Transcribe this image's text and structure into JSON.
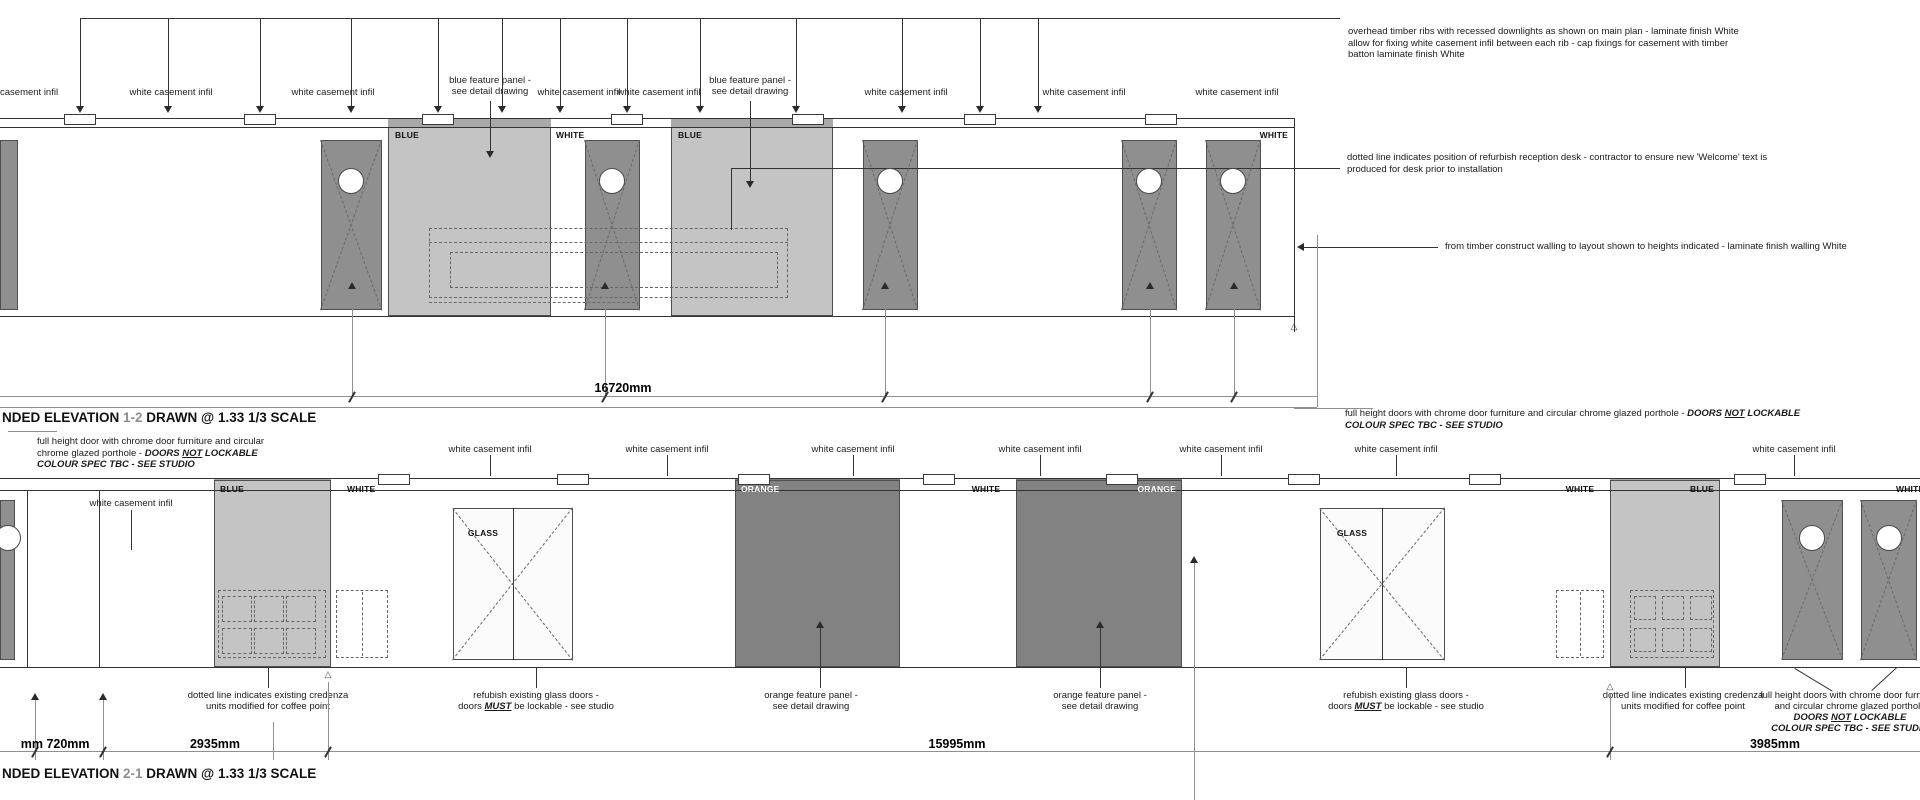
{
  "ann": {
    "a1": {
      "l1": "overhead timber ribs with recessed downlights as shown on main plan - laminate finish White",
      "l2": "allow for fixing white casement infil between each rib - cap fixings for casement with timber",
      "l3": "batton laminate finish White"
    },
    "a2": {
      "l1": "dotted line indicates position of refurbish reception desk - contractor to ensure new 'Welcome' text is",
      "l2": "produced for desk prior to installation"
    },
    "a3": {
      "l1": "from timber construct walling to layout shown to heights indicated - laminate finish walling White"
    },
    "a4": {
      "pre": "full height doors with chrome door furniture and circular chrome glazed porthole - ",
      "b1": "DOORS ",
      "u": "NOT",
      "b2": " LOCKABLE",
      "l2": "COLOUR SPEC TBC - SEE STUDIO"
    },
    "a5": {
      "l1": "full height door with chrome door furniture and circular",
      "pre": "chrome glazed porthole - ",
      "b1": "DOORS ",
      "u": "NOT",
      "b2": " LOCKABLE",
      "l3": "COLOUR SPEC TBC - SEE STUDIO"
    },
    "credenza": {
      "l1": "dotted line indicates existing credenza",
      "l2": "units modified for coffee point"
    },
    "glassdoors": {
      "l1": "refubish existing glass doors -",
      "pre": "doors ",
      "u": "MUST",
      "post": " be lockable - see studio"
    },
    "orangepanel": {
      "l1": "orange feature panel -",
      "l2": "see detail drawing"
    },
    "bottomdoors": {
      "l1": "full height doors with chrome door furniture",
      "l2": "and circular chrome glazed porthole",
      "b1": "DOORS ",
      "u": "NOT",
      "b2": " LOCKABLE",
      "l4": "COLOUR SPEC TBC - SEE STUDIO"
    }
  },
  "titles": {
    "t1_pre": "NDED ELEVATION ",
    "t1_num": "1-2",
    "t1_post": " DRAWN @ 1.33 1/3 SCALE",
    "t2_pre": "NDED ELEVATION ",
    "t2_num": "2-1",
    "t2_post": " DRAWN @ 1.33 1/3 SCALE"
  },
  "colors": {
    "door_fill": "#8f8f8f",
    "blue_panel_fill": "#c4c4c4",
    "orange_panel_fill": "#828282",
    "glass_fill": "#fbfbfb",
    "line_dark": "#333333",
    "line_gray": "#8f8f8f",
    "dash": "#666666",
    "title_number_gray": "#8f8f8f"
  },
  "geom": {
    "rects": [
      [
        388,
        119,
        163,
        8,
        "railblue"
      ],
      [
        671,
        119,
        162,
        8,
        "railblue"
      ],
      [
        388,
        127,
        163,
        189,
        "blue"
      ],
      [
        671,
        127,
        162,
        189,
        "blue"
      ],
      [
        0,
        140,
        18,
        170,
        "door"
      ],
      [
        321,
        140,
        61,
        170,
        "door"
      ],
      [
        585,
        140,
        55,
        170,
        "door"
      ],
      [
        863,
        140,
        55,
        170,
        "door"
      ],
      [
        1122,
        140,
        55,
        170,
        "door"
      ],
      [
        1206,
        140,
        55,
        170,
        "door"
      ],
      [
        214,
        479,
        117,
        11,
        "railblue"
      ],
      [
        1610,
        479,
        110,
        11,
        "railblue"
      ],
      [
        735,
        479,
        165,
        11,
        "railorange"
      ],
      [
        1016,
        479,
        166,
        11,
        "railorange"
      ],
      [
        214,
        480,
        117,
        187,
        "blue"
      ],
      [
        1610,
        480,
        110,
        187,
        "blue"
      ],
      [
        735,
        480,
        165,
        187,
        "orange"
      ],
      [
        1016,
        480,
        166,
        187,
        "orange"
      ],
      [
        453,
        508,
        120,
        152,
        "glass"
      ],
      [
        1320,
        508,
        125,
        152,
        "glass"
      ],
      [
        0,
        500,
        15,
        160,
        "door"
      ],
      [
        1782,
        500,
        61,
        160,
        "door"
      ],
      [
        1861,
        500,
        56,
        160,
        "door"
      ],
      [
        429,
        228,
        359,
        70,
        "dashr"
      ],
      [
        450,
        252,
        328,
        36,
        "dashr"
      ],
      [
        218,
        590,
        108,
        68,
        "dashr"
      ],
      [
        222,
        596,
        30,
        26,
        "dashr"
      ],
      [
        254,
        596,
        30,
        26,
        "dashr"
      ],
      [
        286,
        596,
        30,
        26,
        "dashr"
      ],
      [
        222,
        628,
        30,
        26,
        "dashr"
      ],
      [
        254,
        628,
        30,
        26,
        "dashr"
      ],
      [
        286,
        628,
        30,
        26,
        "dashr"
      ],
      [
        336,
        590,
        52,
        68,
        "dashr"
      ],
      [
        1556,
        590,
        48,
        68,
        "dashr"
      ],
      [
        1630,
        590,
        84,
        68,
        "dashr"
      ],
      [
        1634,
        596,
        22,
        24,
        "dashr"
      ],
      [
        1662,
        596,
        22,
        24,
        "dashr"
      ],
      [
        1690,
        596,
        22,
        24,
        "dashr"
      ],
      [
        1634,
        628,
        22,
        24,
        "dashr"
      ],
      [
        1662,
        628,
        22,
        24,
        "dashr"
      ],
      [
        1690,
        628,
        22,
        24,
        "dashr"
      ]
    ],
    "plates": [
      [
        64,
        114,
        32,
        11
      ],
      [
        244,
        114,
        32,
        11
      ],
      [
        422,
        114,
        32,
        11
      ],
      [
        611,
        114,
        32,
        11
      ],
      [
        792,
        114,
        32,
        11
      ],
      [
        964,
        114,
        32,
        11
      ],
      [
        1145,
        114,
        32,
        11
      ],
      [
        378,
        474,
        32,
        11
      ],
      [
        557,
        474,
        32,
        11
      ],
      [
        738,
        474,
        32,
        11
      ],
      [
        923,
        474,
        32,
        11
      ],
      [
        1106,
        474,
        32,
        11
      ],
      [
        1288,
        474,
        32,
        11
      ],
      [
        1469,
        474,
        32,
        11
      ],
      [
        1734,
        474,
        32,
        11
      ]
    ],
    "lines": [
      [
        80,
        18,
        1340,
        18,
        0
      ],
      [
        80,
        18,
        80,
        106,
        0
      ],
      [
        168,
        18,
        168,
        106,
        0
      ],
      [
        260,
        18,
        260,
        106,
        0
      ],
      [
        351,
        18,
        351,
        106,
        0
      ],
      [
        438,
        18,
        438,
        106,
        0
      ],
      [
        502,
        18,
        502,
        106,
        0
      ],
      [
        560,
        18,
        560,
        106,
        0
      ],
      [
        627,
        18,
        627,
        106,
        0
      ],
      [
        700,
        18,
        700,
        106,
        0
      ],
      [
        796,
        18,
        796,
        106,
        0
      ],
      [
        902,
        18,
        902,
        106,
        0
      ],
      [
        980,
        18,
        980,
        106,
        0
      ],
      [
        1038,
        18,
        1038,
        106,
        0
      ],
      [
        490,
        101,
        490,
        151,
        0
      ],
      [
        750,
        101,
        750,
        181,
        0
      ],
      [
        0,
        118,
        1294,
        118,
        0
      ],
      [
        0,
        127,
        1294,
        127,
        0
      ],
      [
        0,
        316,
        1294,
        316,
        0
      ],
      [
        1294,
        118,
        1294,
        332,
        0
      ],
      [
        731,
        168,
        1340,
        168,
        0
      ],
      [
        731,
        168,
        731,
        230,
        0
      ],
      [
        1299,
        247,
        1438,
        247,
        0
      ],
      [
        1317,
        235,
        1317,
        407,
        1
      ],
      [
        352,
        289,
        352,
        396,
        1
      ],
      [
        605,
        289,
        605,
        396,
        1
      ],
      [
        885,
        289,
        885,
        396,
        1
      ],
      [
        1150,
        289,
        1150,
        396,
        1
      ],
      [
        1234,
        289,
        1234,
        396,
        1
      ],
      [
        0,
        396,
        1317,
        396,
        1
      ],
      [
        0,
        407,
        1317,
        407,
        1
      ],
      [
        1294,
        408,
        1373,
        408,
        1
      ],
      [
        429,
        242,
        788,
        242,
        2
      ],
      [
        429,
        302,
        640,
        302,
        2
      ],
      [
        321,
        140,
        382,
        310,
        2
      ],
      [
        382,
        140,
        321,
        310,
        2
      ],
      [
        585,
        140,
        640,
        310,
        2
      ],
      [
        640,
        140,
        585,
        310,
        2
      ],
      [
        863,
        140,
        918,
        310,
        2
      ],
      [
        918,
        140,
        863,
        310,
        2
      ],
      [
        1122,
        140,
        1177,
        310,
        2
      ],
      [
        1177,
        140,
        1122,
        310,
        2
      ],
      [
        1206,
        140,
        1261,
        310,
        2
      ],
      [
        1261,
        140,
        1206,
        310,
        2
      ],
      [
        8,
        431,
        57,
        431,
        1
      ],
      [
        490,
        455,
        490,
        476,
        0
      ],
      [
        667,
        455,
        667,
        476,
        0
      ],
      [
        853,
        455,
        853,
        476,
        0
      ],
      [
        1040,
        455,
        1040,
        476,
        0
      ],
      [
        1221,
        455,
        1221,
        476,
        0
      ],
      [
        1396,
        455,
        1396,
        476,
        0
      ],
      [
        1794,
        455,
        1794,
        476,
        0
      ],
      [
        131,
        510,
        131,
        550,
        0
      ],
      [
        0,
        478,
        1920,
        478,
        0
      ],
      [
        0,
        490,
        1920,
        490,
        0
      ],
      [
        0,
        667,
        1920,
        667,
        0
      ],
      [
        27,
        490,
        27,
        667,
        0
      ],
      [
        99,
        490,
        99,
        667,
        0
      ],
      [
        513,
        508,
        513,
        660,
        0
      ],
      [
        1382,
        508,
        1382,
        660,
        0
      ],
      [
        453,
        508,
        573,
        660,
        2
      ],
      [
        573,
        508,
        453,
        660,
        2
      ],
      [
        1320,
        508,
        1445,
        660,
        2
      ],
      [
        1445,
        508,
        1320,
        660,
        2
      ],
      [
        1782,
        500,
        1843,
        660,
        2
      ],
      [
        1843,
        500,
        1782,
        660,
        2
      ],
      [
        1861,
        500,
        1917,
        660,
        2
      ],
      [
        1917,
        500,
        1861,
        660,
        2
      ],
      [
        362,
        592,
        362,
        656,
        2
      ],
      [
        1580,
        592,
        1580,
        656,
        2
      ],
      [
        1194,
        563,
        1194,
        800,
        1
      ],
      [
        268,
        667,
        268,
        688,
        0
      ],
      [
        536,
        667,
        536,
        688,
        0
      ],
      [
        820,
        628,
        820,
        688,
        0
      ],
      [
        1100,
        628,
        1100,
        688,
        0
      ],
      [
        1406,
        667,
        1406,
        688,
        0
      ],
      [
        1685,
        667,
        1685,
        688,
        0
      ],
      [
        1795,
        668,
        1833,
        691,
        0
      ],
      [
        1897,
        668,
        1872,
        691,
        0
      ],
      [
        35,
        700,
        35,
        760,
        1
      ],
      [
        103,
        700,
        103,
        760,
        1
      ],
      [
        273,
        722,
        273,
        760,
        1
      ],
      [
        328,
        682,
        328,
        760,
        1
      ],
      [
        1610,
        694,
        1610,
        760,
        1
      ],
      [
        0,
        751,
        1920,
        751,
        1
      ]
    ],
    "circles": [
      [
        351,
        181,
        13
      ],
      [
        612,
        181,
        13
      ],
      [
        890,
        181,
        13
      ],
      [
        1149,
        181,
        13
      ],
      [
        1233,
        181,
        13
      ],
      [
        8,
        538,
        13
      ],
      [
        1812,
        538,
        13
      ],
      [
        1889,
        538,
        13
      ]
    ],
    "arrows": [
      [
        80,
        113,
        "d"
      ],
      [
        168,
        113,
        "d"
      ],
      [
        260,
        113,
        "d"
      ],
      [
        351,
        113,
        "d"
      ],
      [
        438,
        113,
        "d"
      ],
      [
        502,
        113,
        "d"
      ],
      [
        560,
        113,
        "d"
      ],
      [
        627,
        113,
        "d"
      ],
      [
        700,
        113,
        "d"
      ],
      [
        796,
        113,
        "d"
      ],
      [
        902,
        113,
        "d"
      ],
      [
        980,
        113,
        "d"
      ],
      [
        1038,
        113,
        "d"
      ],
      [
        490,
        158,
        "d"
      ],
      [
        750,
        188,
        "d"
      ],
      [
        352,
        282,
        "u"
      ],
      [
        605,
        282,
        "u"
      ],
      [
        885,
        282,
        "u"
      ],
      [
        1150,
        282,
        "u"
      ],
      [
        1234,
        282,
        "u"
      ],
      [
        1194,
        556,
        "u"
      ],
      [
        820,
        621,
        "u"
      ],
      [
        1100,
        621,
        "u"
      ],
      [
        35,
        693,
        "u"
      ],
      [
        103,
        693,
        "u"
      ],
      [
        1297,
        247,
        "l"
      ]
    ],
    "ticks": [
      [
        352,
        396
      ],
      [
        605,
        396
      ],
      [
        885,
        396
      ],
      [
        1150,
        396
      ],
      [
        1234,
        396
      ],
      [
        35,
        751
      ],
      [
        103,
        751
      ],
      [
        328,
        751
      ],
      [
        1610,
        751
      ]
    ],
    "texts": [
      [
        0,
        87,
        "casement infil",
        "lbl",
        "l"
      ],
      [
        171,
        87,
        "white casement infil",
        "lbl",
        "c"
      ],
      [
        333,
        87,
        "white casement infil",
        "lbl",
        "c"
      ],
      [
        490,
        75,
        "blue feature panel -",
        "lbl",
        "c"
      ],
      [
        490,
        86,
        "see detail drawing",
        "lbl",
        "c"
      ],
      [
        579,
        87,
        "white casement infil",
        "lbl",
        "c"
      ],
      [
        659,
        87,
        "white casement infil",
        "lbl",
        "c"
      ],
      [
        750,
        75,
        "blue feature panel -",
        "lbl",
        "c"
      ],
      [
        750,
        86,
        "see detail drawing",
        "lbl",
        "c"
      ],
      [
        906,
        87,
        "white casement infil",
        "lbl",
        "c"
      ],
      [
        1084,
        87,
        "white casement infil",
        "lbl",
        "c"
      ],
      [
        1237,
        87,
        "white casement infil",
        "lbl",
        "c"
      ],
      [
        395,
        130,
        "BLUE",
        "plabel",
        "l"
      ],
      [
        678,
        130,
        "BLUE",
        "plabel",
        "l"
      ],
      [
        556,
        130,
        "WHITE",
        "plabel",
        "l"
      ],
      [
        1288,
        130,
        "WHITE",
        "plabel",
        "r"
      ],
      [
        623,
        381,
        "16720mm",
        "dim",
        "c"
      ],
      [
        131,
        498,
        "white casement infil",
        "lbl",
        "c"
      ],
      [
        490,
        444,
        "white casement infil",
        "lbl",
        "c"
      ],
      [
        667,
        444,
        "white casement infil",
        "lbl",
        "c"
      ],
      [
        853,
        444,
        "white casement infil",
        "lbl",
        "c"
      ],
      [
        1040,
        444,
        "white casement infil",
        "lbl",
        "c"
      ],
      [
        1221,
        444,
        "white casement infil",
        "lbl",
        "c"
      ],
      [
        1396,
        444,
        "white casement infil",
        "lbl",
        "c"
      ],
      [
        1794,
        444,
        "white casement infil",
        "lbl",
        "c"
      ],
      [
        220,
        484,
        "BLUE",
        "plabel",
        "l"
      ],
      [
        1714,
        484,
        "BLUE",
        "plabel",
        "r"
      ],
      [
        347,
        484,
        "WHITE",
        "plabel",
        "l"
      ],
      [
        986,
        484,
        "WHITE",
        "plabel",
        "c"
      ],
      [
        1580,
        484,
        "WHITE",
        "plabel",
        "c"
      ],
      [
        1896,
        484,
        "WHITE",
        "plabel",
        "l"
      ],
      [
        741,
        484,
        "ORANGE",
        "plabelw",
        "l"
      ],
      [
        1176,
        484,
        "ORANGE",
        "plabelw",
        "r"
      ],
      [
        483,
        528,
        "GLASS",
        "plabel",
        "c"
      ],
      [
        1352,
        528,
        "GLASS",
        "plabel",
        "c"
      ],
      [
        43,
        737,
        "mm",
        "dim",
        "r"
      ],
      [
        68,
        737,
        "720mm",
        "dim",
        "c"
      ],
      [
        215,
        737,
        "2935mm",
        "dim",
        "c"
      ],
      [
        957,
        737,
        "15995mm",
        "dim",
        "c"
      ],
      [
        1775,
        737,
        "3985mm",
        "dim",
        "c"
      ],
      [
        1294,
        321,
        "△",
        "tri",
        "c"
      ],
      [
        328,
        669,
        "△",
        "tri",
        "c"
      ],
      [
        1610,
        681,
        "△",
        "tri",
        "c"
      ]
    ]
  }
}
